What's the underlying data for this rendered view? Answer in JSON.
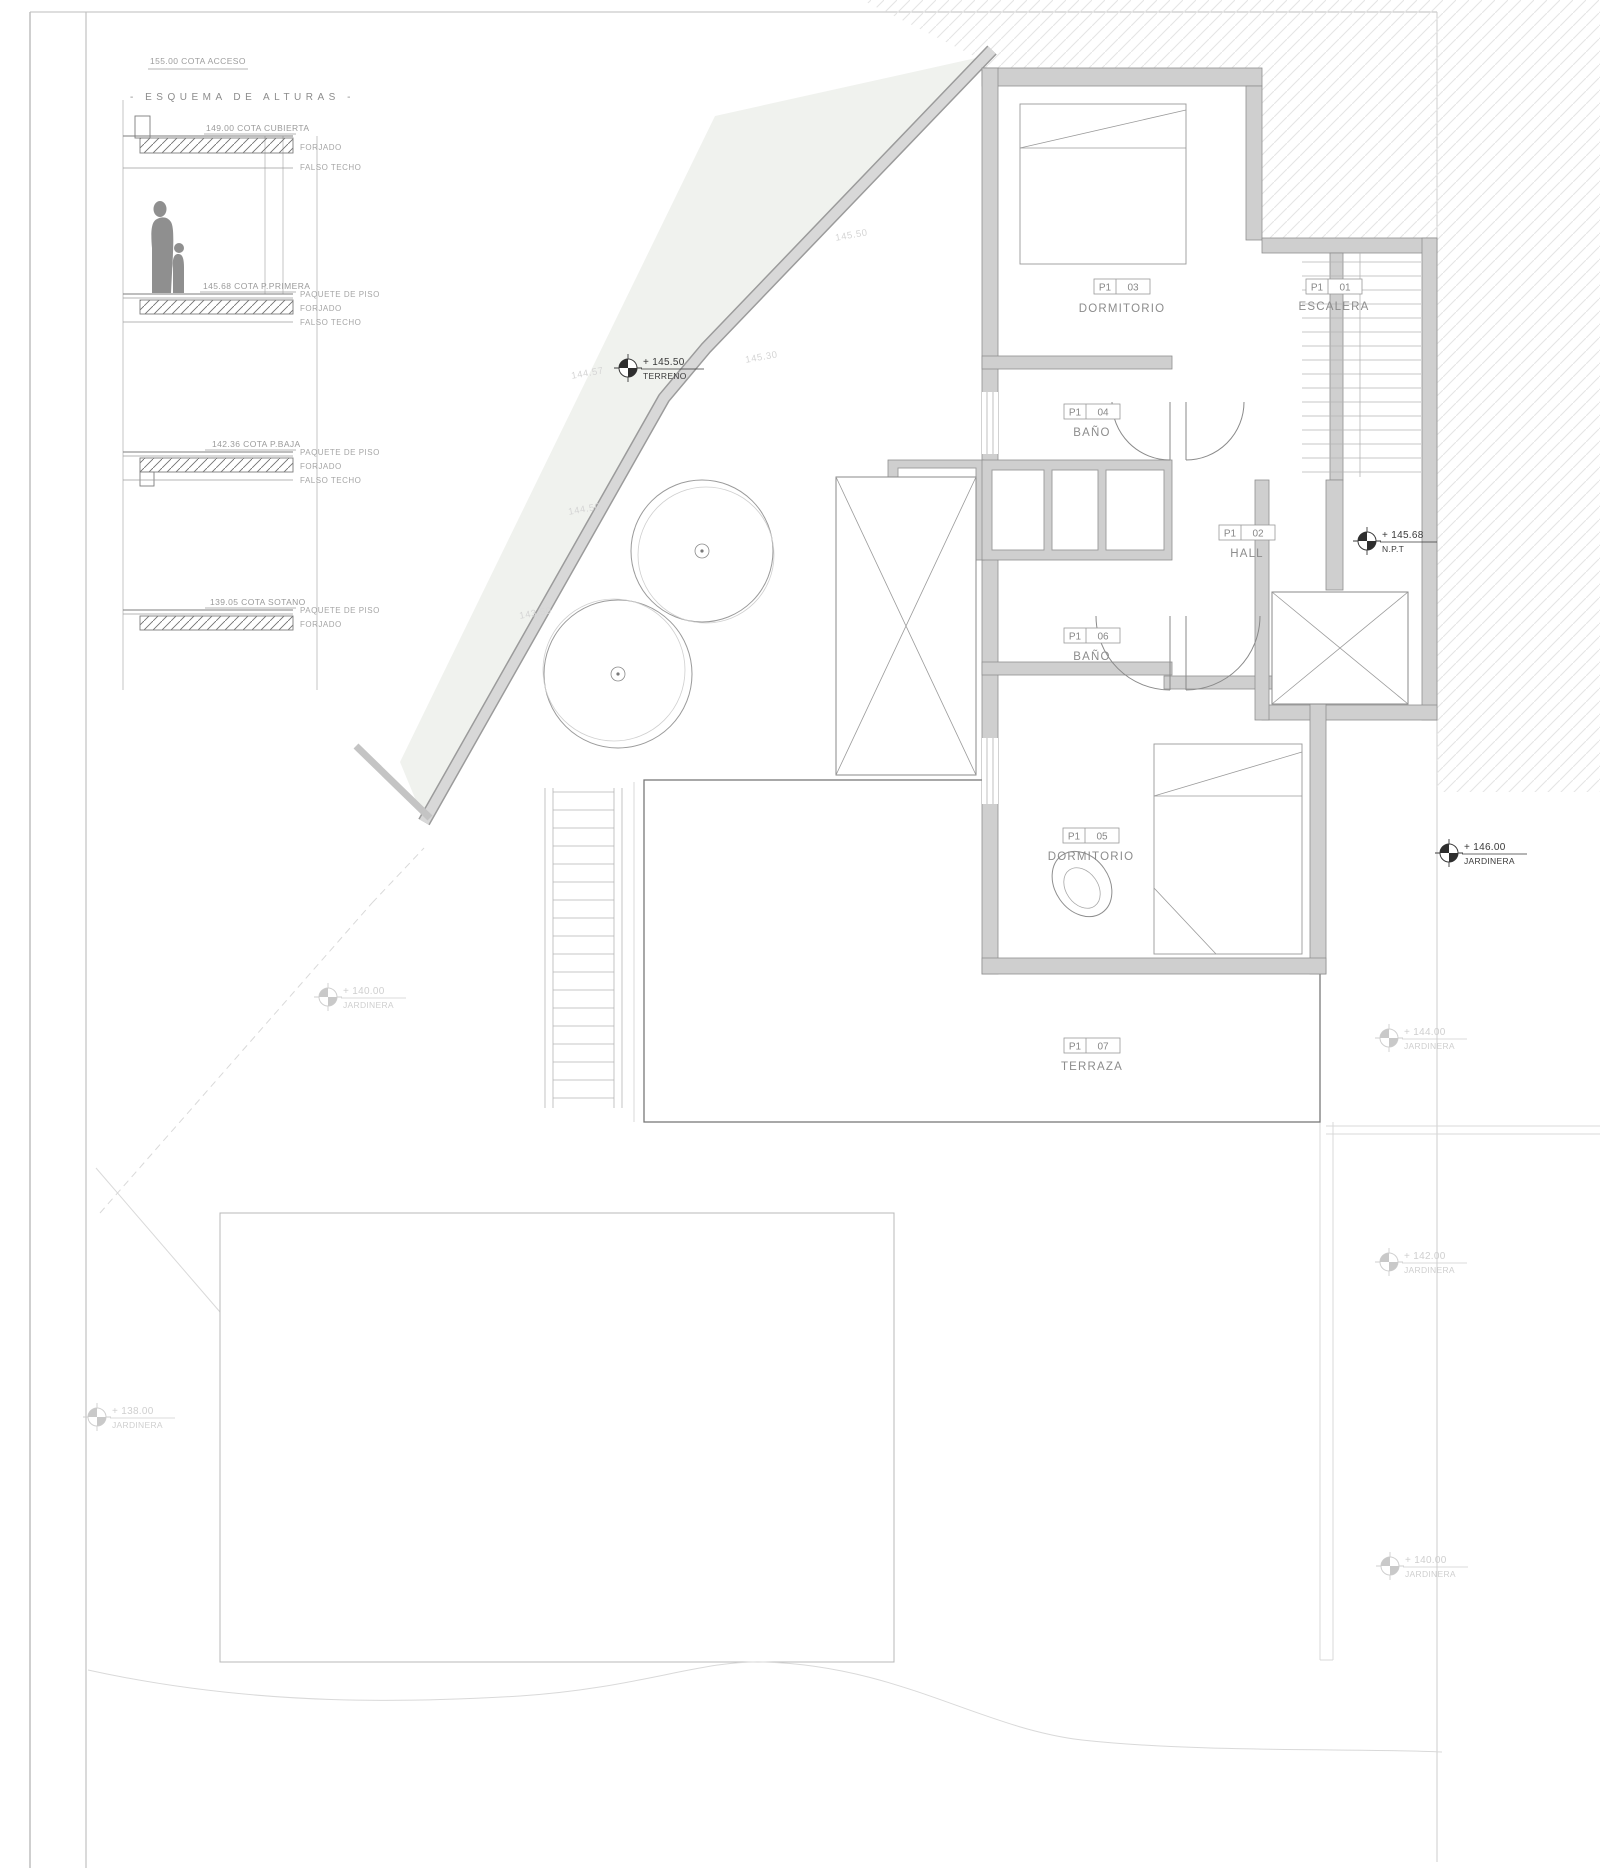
{
  "colors": {
    "wall_fill": "#cfcfcf",
    "wall_edge": "#8f8f8f",
    "hatch_line": "#e5e5e5",
    "slope_fill": "#f0f2ee",
    "text_gray": "#8c8c8c",
    "text_faint": "#d0d0d0",
    "marker_dark": "#2e2e2e"
  },
  "schema": {
    "access_note": "155.00 COTA ACCESO",
    "title": "- ESQUEMA DE ALTURAS -",
    "levels": [
      {
        "cota": "149.00 COTA CUBIERTA",
        "layers": [
          "FORJADO",
          "FALSO TECHO"
        ]
      },
      {
        "cota": "145.68 COTA P.PRIMERA",
        "layers": [
          "PAQUETE DE PISO",
          "FORJADO",
          "FALSO TECHO"
        ]
      },
      {
        "cota": "142.36 COTA P.BAJA",
        "layers": [
          "PAQUETE DE PISO",
          "FORJADO",
          "FALSO TECHO"
        ]
      },
      {
        "cota": "139.05 COTA SOTANO",
        "layers": [
          "PAQUETE DE PISO",
          "FORJADO"
        ]
      }
    ]
  },
  "rooms": [
    {
      "code": "P1",
      "num": "01",
      "name": "ESCALERA"
    },
    {
      "code": "P1",
      "num": "02",
      "name": "HALL"
    },
    {
      "code": "P1",
      "num": "03",
      "name": "DORMITORIO"
    },
    {
      "code": "P1",
      "num": "04",
      "name": "BAÑO"
    },
    {
      "code": "P1",
      "num": "05",
      "name": "DORMITORIO"
    },
    {
      "code": "P1",
      "num": "06",
      "name": "BAÑO"
    },
    {
      "code": "P1",
      "num": "07",
      "name": "TERRAZA"
    }
  ],
  "markers": [
    {
      "value": "+ 145.50",
      "label": "TERRENO"
    },
    {
      "value": "+ 145.68",
      "label": "N.P.T"
    },
    {
      "value": "+ 146.00",
      "label": "JARDINERA"
    },
    {
      "value": "+ 144.00",
      "label": "JARDINERA"
    },
    {
      "value": "+ 142.00",
      "label": "JARDINERA"
    },
    {
      "value": "+ 140.00",
      "label": "JARDINERA"
    },
    {
      "value": "+ 140.00",
      "label": "JARDINERA"
    },
    {
      "value": "+ 138.00",
      "label": "JARDINERA"
    }
  ],
  "contours": [
    "145.50",
    "145.30",
    "144.57",
    "144.50",
    "143.50"
  ]
}
